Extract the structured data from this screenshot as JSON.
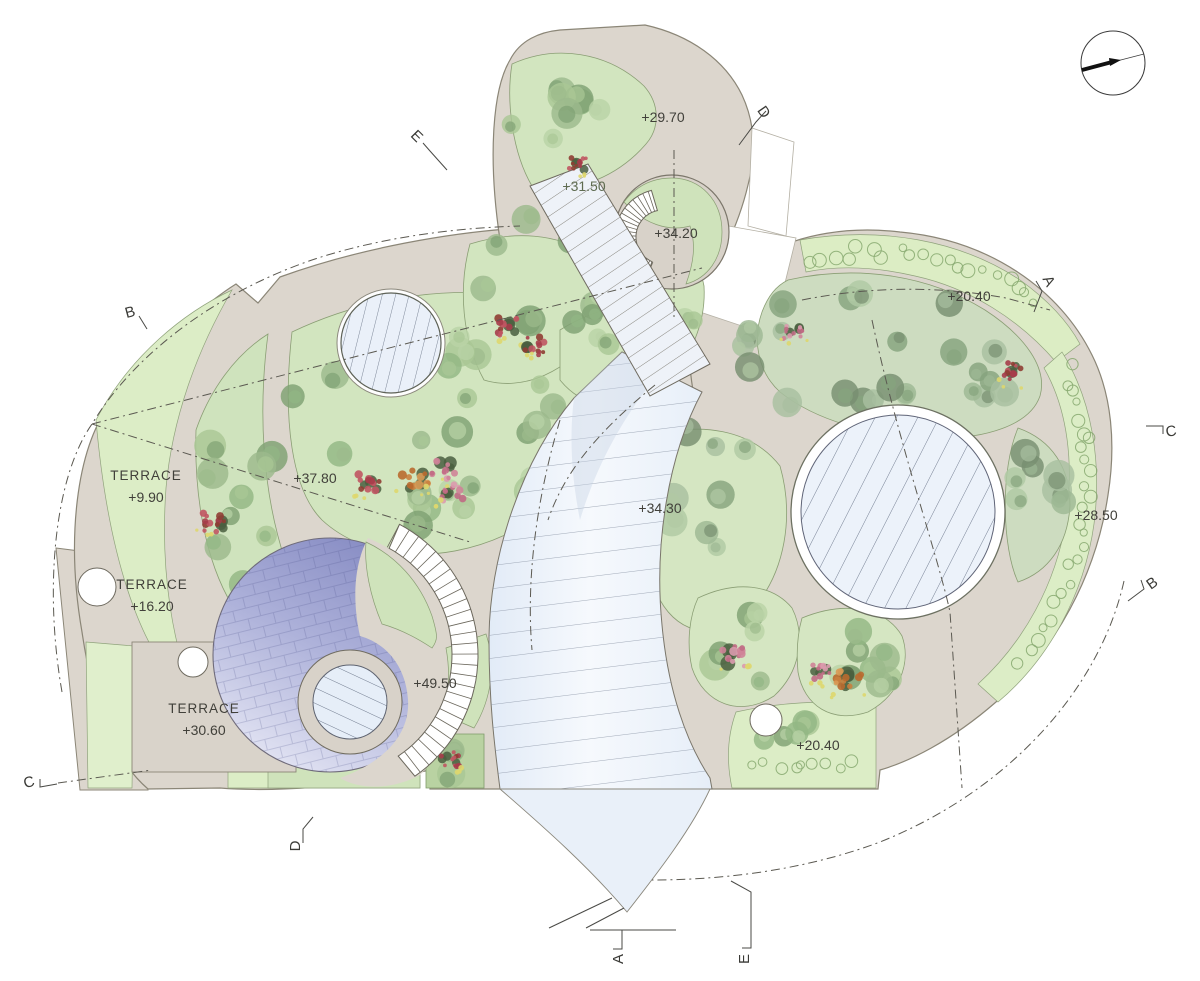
{
  "plan": {
    "elevations": {
      "e1": "+29.70",
      "e2": "+31.50",
      "e3": "+34.20",
      "e4": "+20.40",
      "e5": "+37.80",
      "e6": "+34.30",
      "e7": "+28.50",
      "e8": "+49.50",
      "e9": "+20.40"
    },
    "terraces": [
      {
        "name": "TERRACE",
        "level": "+9.90"
      },
      {
        "name": "TERRACE",
        "level": "+16.20"
      },
      {
        "name": "TERRACE",
        "level": "+30.60"
      }
    ],
    "sections": {
      "e_top": "E",
      "d_top": "D",
      "b_left": "B",
      "a_right": "A",
      "c_right": "C",
      "b_right": "B",
      "c_left": "C",
      "d_bottom": "D",
      "a_bottom": "A",
      "e_bottom": "E"
    },
    "colors": {
      "path": "#dcd6cd",
      "planting": "#d2e5bf",
      "hedge": "#dcedc6",
      "water": "#e9f0f8",
      "dome": "#9297c9",
      "flower": "#b04a52"
    }
  }
}
